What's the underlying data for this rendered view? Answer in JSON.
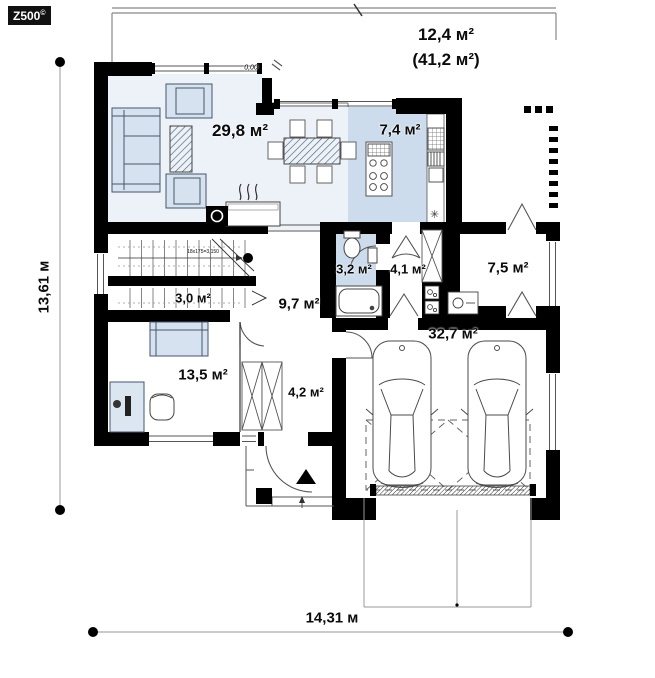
{
  "brand": {
    "logo_text": "Z500",
    "logo_mark": "©"
  },
  "rooms": {
    "terrace": {
      "area": "12,4 м²",
      "area_total": "(41,2 м²)"
    },
    "living_room": {
      "area": "29,8 м²"
    },
    "kitchen": {
      "area": "7,4 м²"
    },
    "bathroom": {
      "area": "3,2 м²"
    },
    "hall": {
      "area": "4,1 м²"
    },
    "utility": {
      "area": "7,5 м²"
    },
    "pantry": {
      "area": "3,0 м²"
    },
    "hallway": {
      "area": "9,7 м²"
    },
    "cabinet": {
      "area": "13,5 м²"
    },
    "entry": {
      "area": "4,2 м²"
    },
    "garage": {
      "area": "32,7 м²"
    }
  },
  "dimensions": {
    "total_depth": "13,61 м",
    "total_width": "14,31 м"
  },
  "annotations": {
    "floor_level": "0,00",
    "stair_note": "18x175=3,150",
    "fridge_symbol": "✳"
  },
  "colors": {
    "wall": "#000000",
    "floor_light": "#edf2f8",
    "floor_blue": "#cddcec",
    "furniture": "#d6e2ef",
    "line": "#555555"
  }
}
